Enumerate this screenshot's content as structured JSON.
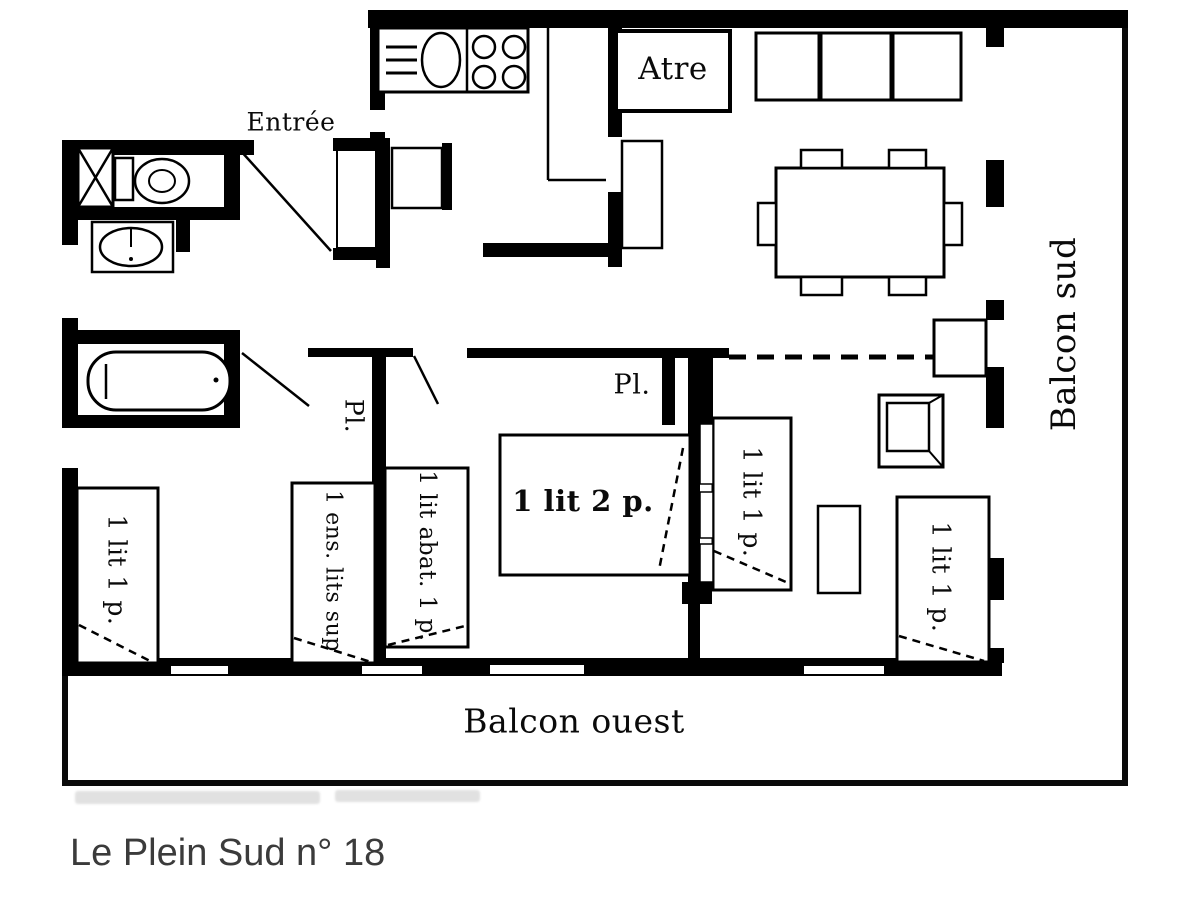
{
  "title": "Le Plein Sud n° 18",
  "labels": {
    "entree": "Entrée",
    "atre": "Atre",
    "balcon_sud": "Balcon sud",
    "balcon_ouest": "Balcon ouest",
    "pl_left": "Pl.",
    "pl_center": "Pl.",
    "bed_single_left": "1 lit 1 p.",
    "bed_bunk": "1 ens. lits sup",
    "bed_folding": "1 lit abat. 1 p.",
    "bed_double": "1 lit 2 p.",
    "bed_single_middle": "1 lit 1 p.",
    "bed_single_right": "1 lit 1 p."
  },
  "colors": {
    "wall": "#000000",
    "background": "#ffffff",
    "title_text": "#3b3b3b",
    "watermark": "#d2d2d2"
  }
}
